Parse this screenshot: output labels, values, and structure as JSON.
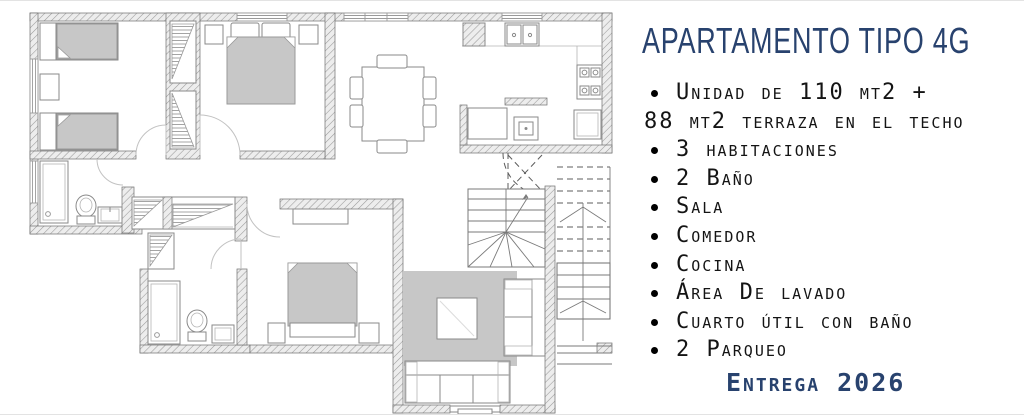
{
  "panel": {
    "title": "APARTAMENTO TIPO 4G",
    "bullet_glyph": "•",
    "features": [
      {
        "bullet": true,
        "text": "Unidad de 110 mt2 +"
      },
      {
        "bullet": false,
        "text": "88 mt2 terraza en el techo"
      },
      {
        "bullet": true,
        "text": "3 habitaciones"
      },
      {
        "bullet": true,
        "text": "2 Baño"
      },
      {
        "bullet": true,
        "text": "Sala"
      },
      {
        "bullet": true,
        "text": "Comedor"
      },
      {
        "bullet": true,
        "text": "Cocina"
      },
      {
        "bullet": true,
        "text": "Área De lavado"
      },
      {
        "bullet": true,
        "text": "Cuarto útil con baño"
      },
      {
        "bullet": true,
        "text": "2 Parqueo"
      }
    ],
    "delivery": "Entrega 2026"
  },
  "colors": {
    "accent_navy": "#28426e",
    "text_black": "#141414",
    "wall_fill": "#ededed",
    "wall_hatch_line": "#9a9a9a",
    "furniture_gray": "#c7c7c7",
    "background": "#ffffff"
  }
}
